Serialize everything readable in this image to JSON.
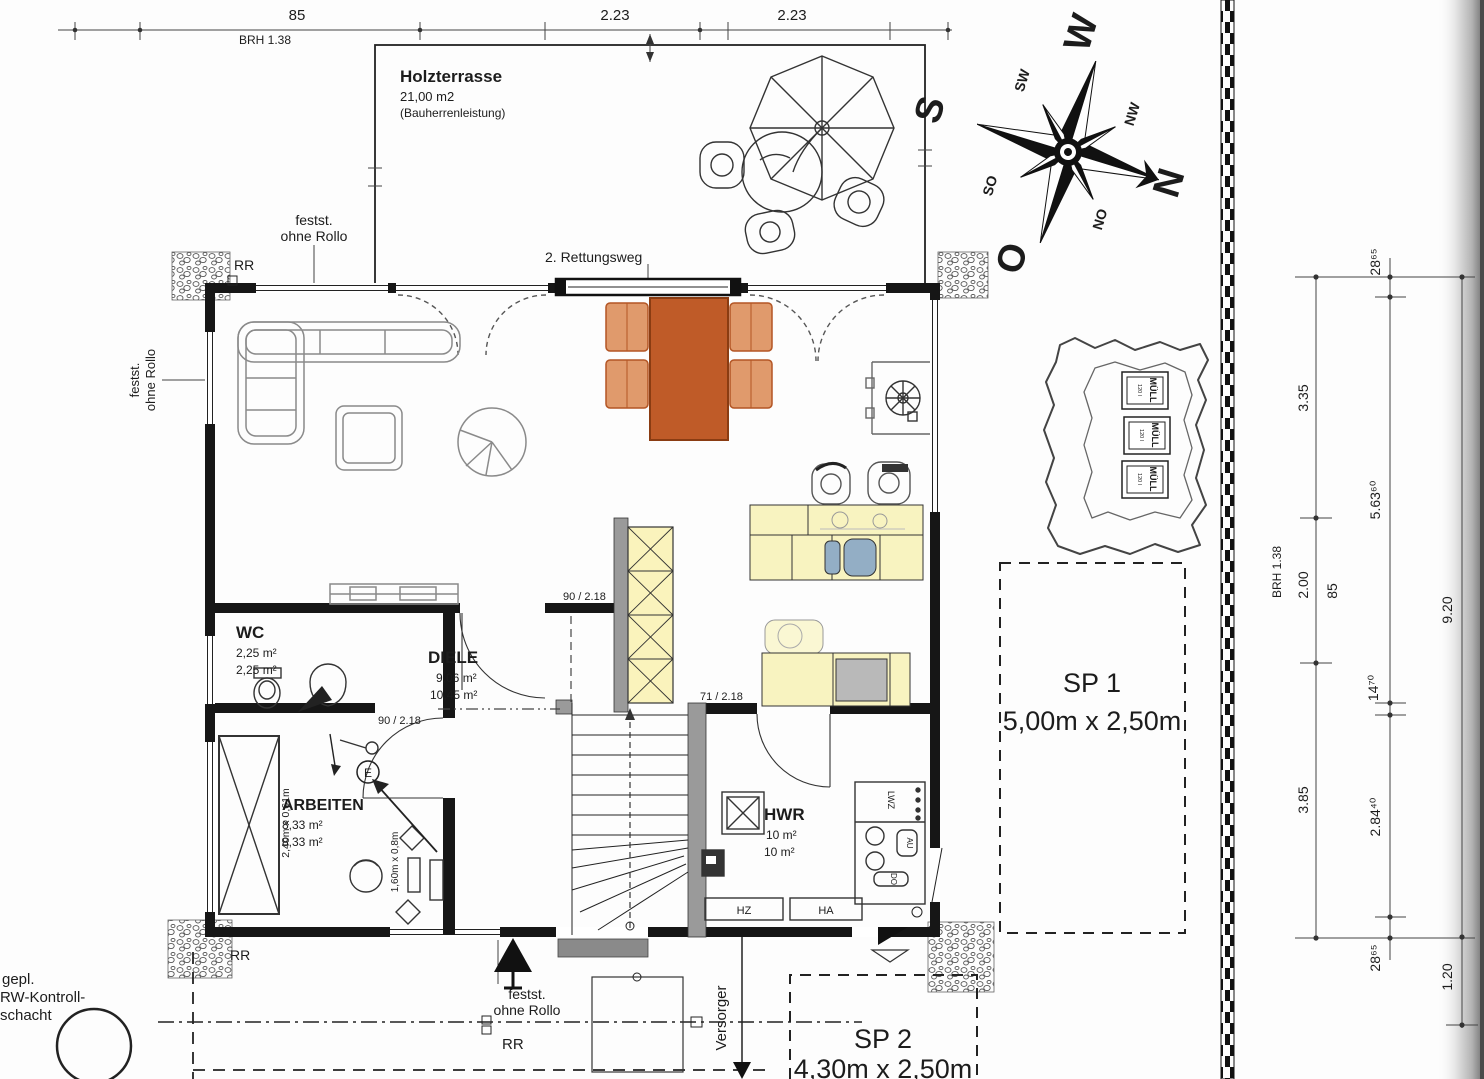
{
  "top_dims": {
    "seg85": "85",
    "brh": "BRH 1.38",
    "seg223a": "2.23",
    "seg223b": "2.23"
  },
  "terrace": {
    "title": "Holzterrasse",
    "area": "21,00 m2",
    "note": "(Bauherrenleistung)",
    "rescue": "2. Rettungsweg"
  },
  "window_labels": {
    "festst": "festst.",
    "ohne_rollo": "ohne Rollo",
    "rr": "RR"
  },
  "rooms": {
    "wc": {
      "name": "WC",
      "area1": "2,25 m²",
      "area2": "2,25 m²"
    },
    "diele": {
      "name": "DIELE",
      "area1": "9,06 m²",
      "area2": "10,45 m²"
    },
    "arbeiten": {
      "name": "ARBEITEN",
      "area1": "8,33 m²",
      "area2": "8,33 m²"
    },
    "hwr": {
      "name": "HWR",
      "area1": "10 m²",
      "area2": "10 m²"
    }
  },
  "doors": {
    "d90": "90 / 2.18",
    "d71": "71 / 2.18"
  },
  "furniture": {
    "wardrobe_size": "2,40m x 0,61m",
    "desk_size": "1,60m x 0,8m",
    "e_mark": "E"
  },
  "hwr_items": {
    "lwz": "LWZ",
    "au": "AU",
    "do": "DO",
    "hz": "HZ",
    "ha": "HA"
  },
  "muell": {
    "label": "MÜLL",
    "size": "120 l"
  },
  "compass": {
    "n": "N",
    "s": "S",
    "o": "O",
    "w": "W",
    "no": "NO",
    "nw": "NW",
    "so": "SO",
    "sw": "SW"
  },
  "parking": {
    "sp1_name": "SP 1",
    "sp1_size": "5,00m x 2,50m",
    "sp2_name": "SP 2",
    "sp2_size": "4,30m x 2,50m"
  },
  "site": {
    "versorger": "Versorger",
    "rw1": "gepl.",
    "rw2": "RW-Kontroll-",
    "rw3": "schacht"
  },
  "right_dims": {
    "w2865": "28⁶⁵",
    "d335": "3.35",
    "d56360": "5.63⁶⁰",
    "d200": "2.00",
    "d85": "85",
    "brh": "BRH 1.38",
    "d1470": "14⁷⁰",
    "d385": "3.85",
    "d28440": "2.84⁴⁰",
    "d920": "9.20",
    "d120": "1.20"
  },
  "colors": {
    "wall": "#161616",
    "table_orange": "#bf5b28",
    "chair_orange": "#e09a6c",
    "counter_yellow": "#f8f3c0",
    "sink_blue": "#93aec5",
    "appliance_gray": "#b9b9b9"
  }
}
